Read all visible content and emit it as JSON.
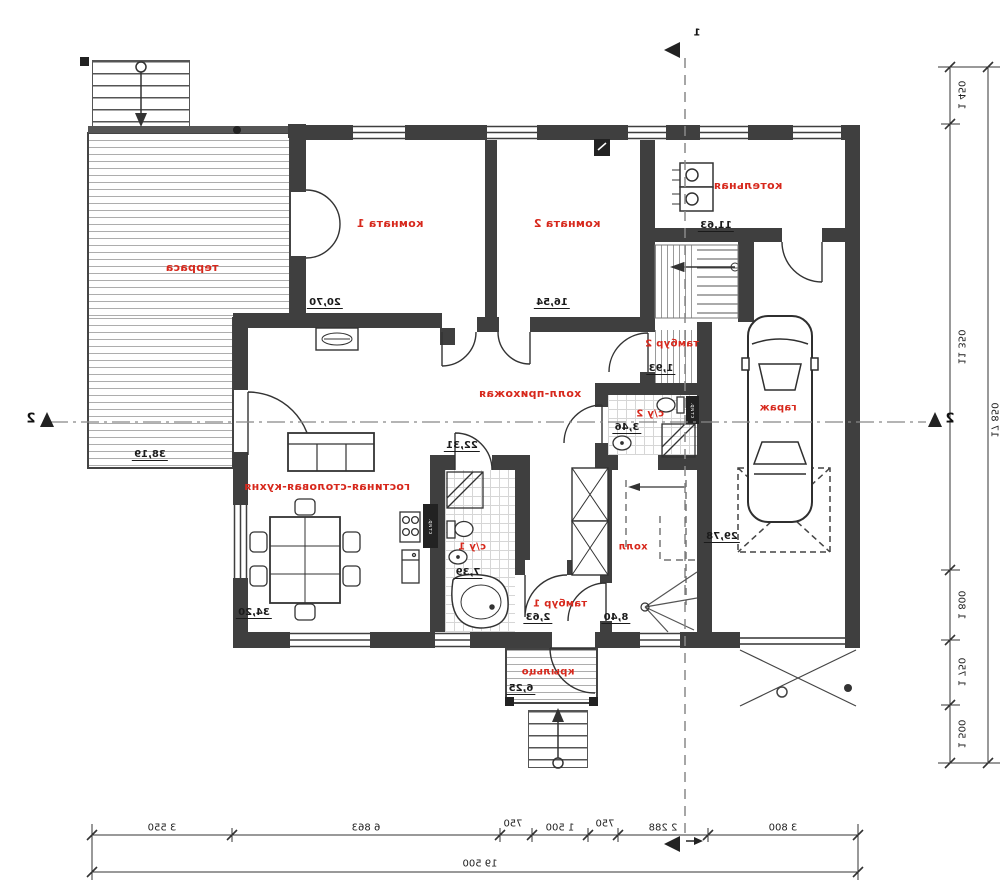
{
  "drawing": {
    "type": "mirrored floor plan scan",
    "wall_color": "#3f3f3f",
    "room_label_color": "#d7281c"
  },
  "rooms": [
    {
      "id": "terrace",
      "label": "терраса",
      "area": "38,19"
    },
    {
      "id": "room1",
      "label": "комната 1",
      "area": "20,70"
    },
    {
      "id": "room2",
      "label": "комната 2",
      "area": "16,54"
    },
    {
      "id": "boiler",
      "label": "котельная",
      "area": "11,63"
    },
    {
      "id": "vestibule2",
      "label": "тамбур 2",
      "area": "1,93"
    },
    {
      "id": "garage",
      "label": "гараж",
      "area": "29,78"
    },
    {
      "id": "hall_entry",
      "label": "холл-прихожая",
      "area": "22,31"
    },
    {
      "id": "wc2",
      "label": "с/у 2",
      "area": "3,46"
    },
    {
      "id": "living",
      "label": "гостиная-столовая-кухня",
      "area": "34,20"
    },
    {
      "id": "wc1",
      "label": "с/у 1",
      "area": "7,39"
    },
    {
      "id": "vestibule1",
      "label": "тамбур 1",
      "area": "2,63"
    },
    {
      "id": "hall",
      "label": "холл",
      "area": "8,40"
    },
    {
      "id": "porch",
      "label": "крыльцо",
      "area": "6,25"
    }
  ],
  "appliances": {
    "washer_label": "стир."
  },
  "dimensions": {
    "bottom": {
      "segments": [
        "3 550",
        "6 863",
        "750",
        "1 500",
        "750",
        "2 288",
        "3 800"
      ],
      "total": "19 500"
    },
    "right": {
      "segments": [
        "1 450",
        "11 350",
        "1 800",
        "1 750",
        "1 500"
      ],
      "total": "17 850"
    }
  },
  "sections": {
    "horizontal_label": "2",
    "vertical_label": "1"
  }
}
